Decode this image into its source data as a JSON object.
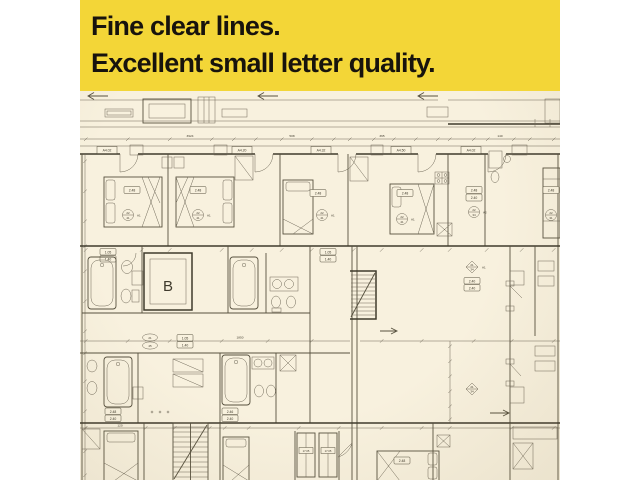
{
  "banner": {
    "line1": "Fine clear lines.",
    "line2": "Excellent small letter quality.",
    "bg": "#f3d637",
    "text_color": "#17130d"
  },
  "plan": {
    "bg": "#f8f1de",
    "ink": "#57513f",
    "elevator_label": "B",
    "door_tags": {
      "t1": "A4.02",
      "t2": "A4.20",
      "t3": "A4.32",
      "t4": "A4.50",
      "t5": "A4.02"
    },
    "room_tags": {
      "r1": "2.48",
      "r2": "2.48",
      "r3": "2.48",
      "r4": "2.48",
      "r5a": "2.48",
      "r5b": "2.40",
      "r6": "2.48",
      "mid_a": "2.40",
      "mid_b": "2.40",
      "bl_a": "2.48",
      "bl_b": "2.40",
      "bm_a": "2.46",
      "bm_b": "2.40",
      "br": "2.48"
    },
    "circle_tags": {
      "c1": {
        "t": "22",
        "b": "41"
      },
      "c2": {
        "t": "22",
        "b": "41"
      },
      "c3": {
        "t": "22",
        "b": "41"
      },
      "c4": {
        "t": "22",
        "b": "41"
      },
      "c5": {
        "t": "22",
        "b": "34"
      },
      "c6": {
        "t": "22",
        "b": "31"
      },
      "d1": {
        "t": "21",
        "b": "34"
      },
      "d2": {
        "t": "21",
        "b": "34"
      },
      "o1": {
        "t": "21",
        "b": "45"
      }
    },
    "unit_notes": {
      "n1": "A1",
      "n2": "A1",
      "n3": "A1",
      "n4": "A1",
      "n5": "A2",
      "n6": "A1"
    },
    "window_tags": {
      "w1a": "1.05",
      "w1b": "1.40",
      "w2a": "1.05",
      "w2b": "1.40",
      "w3a": "1.05",
      "w3b": "1.40"
    },
    "closet_tags": {
      "k1": "17.05",
      "k2": "17.05"
    },
    "dims": {
      "total": "3924",
      "d1": "508",
      "d2": "365",
      "d3": "140",
      "d4": "1850",
      "d5": "120"
    }
  }
}
